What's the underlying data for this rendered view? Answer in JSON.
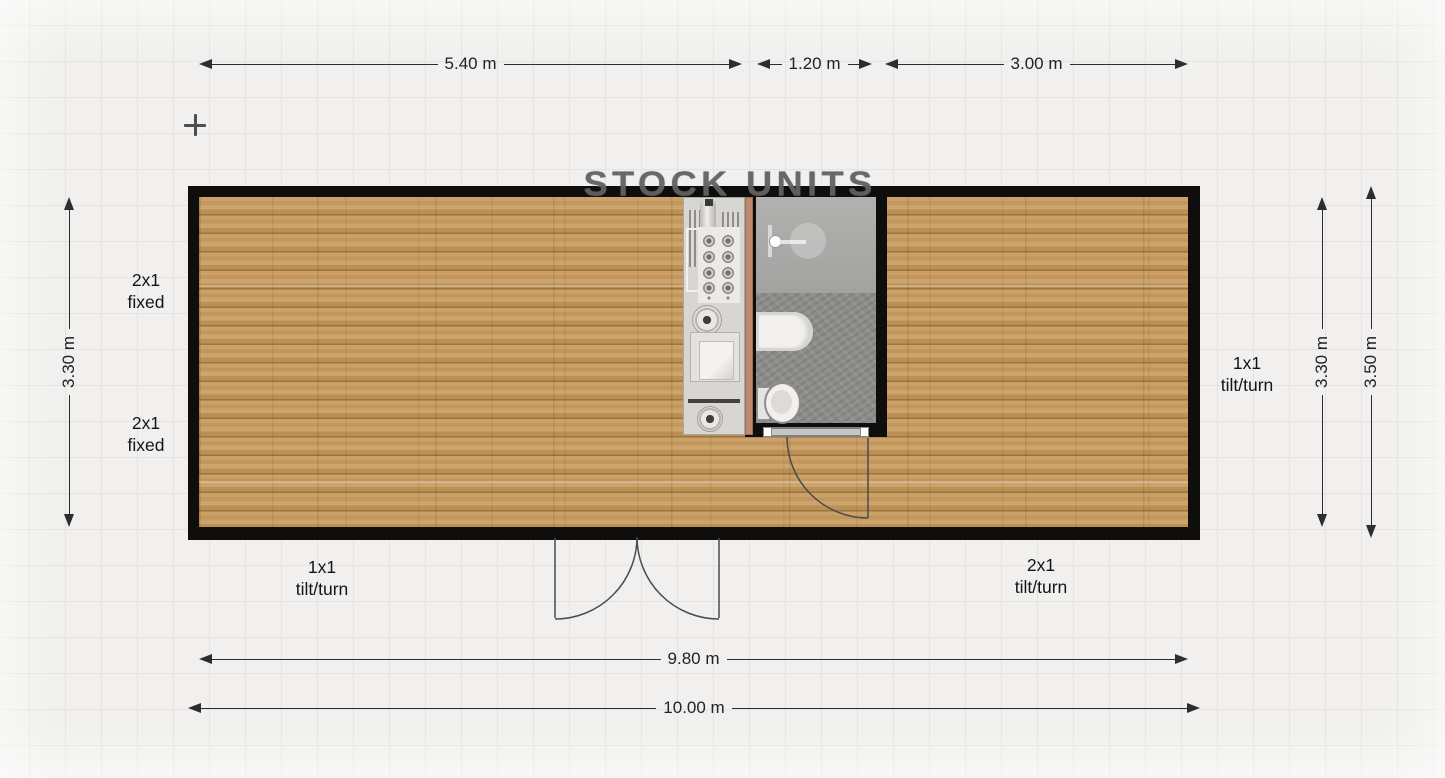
{
  "app": {
    "watermark": "STOCK UNITS"
  },
  "plan": {
    "dimensions": {
      "top_left_width": "5.40 m",
      "top_middle_width": "1.20 m",
      "top_right_width": "3.00 m",
      "bottom_inner_width": "9.80 m",
      "bottom_outer_width": "10.00 m",
      "left_inner_height": "3.30 m",
      "right_inner_height": "3.30 m",
      "right_outer_height": "3.50 m"
    },
    "window_labels": {
      "left_top": {
        "line1": "2x1",
        "line2": "fixed"
      },
      "left_bottom": {
        "line1": "2x1",
        "line2": "fixed"
      },
      "right": {
        "line1": "1x1",
        "line2": "tilt/turn"
      },
      "front_left": {
        "line1": "1x1",
        "line2": "tilt/turn"
      },
      "front_right": {
        "line1": "2x1",
        "line2": "tilt/turn"
      }
    },
    "rooms": [
      "main-room",
      "bathroom"
    ],
    "fixtures": [
      "kitchen-counter",
      "cooktop",
      "kitchen-sink",
      "appliance",
      "bathtub",
      "shower",
      "toilet"
    ],
    "doors": [
      "front-double-door",
      "bathroom-door"
    ],
    "colors": {
      "background": "#f1f0ee",
      "grid": "#e5e3e1",
      "wall": "#0f0e0c",
      "wood_floor": "#c49a5f",
      "counter": "#d8d6d2",
      "counter_edge": "#bd8a6f",
      "bathroom_floor": "#8d8c8a",
      "shower_area": "#a9a8a6",
      "dimension_line": "#2d2d2d"
    }
  }
}
